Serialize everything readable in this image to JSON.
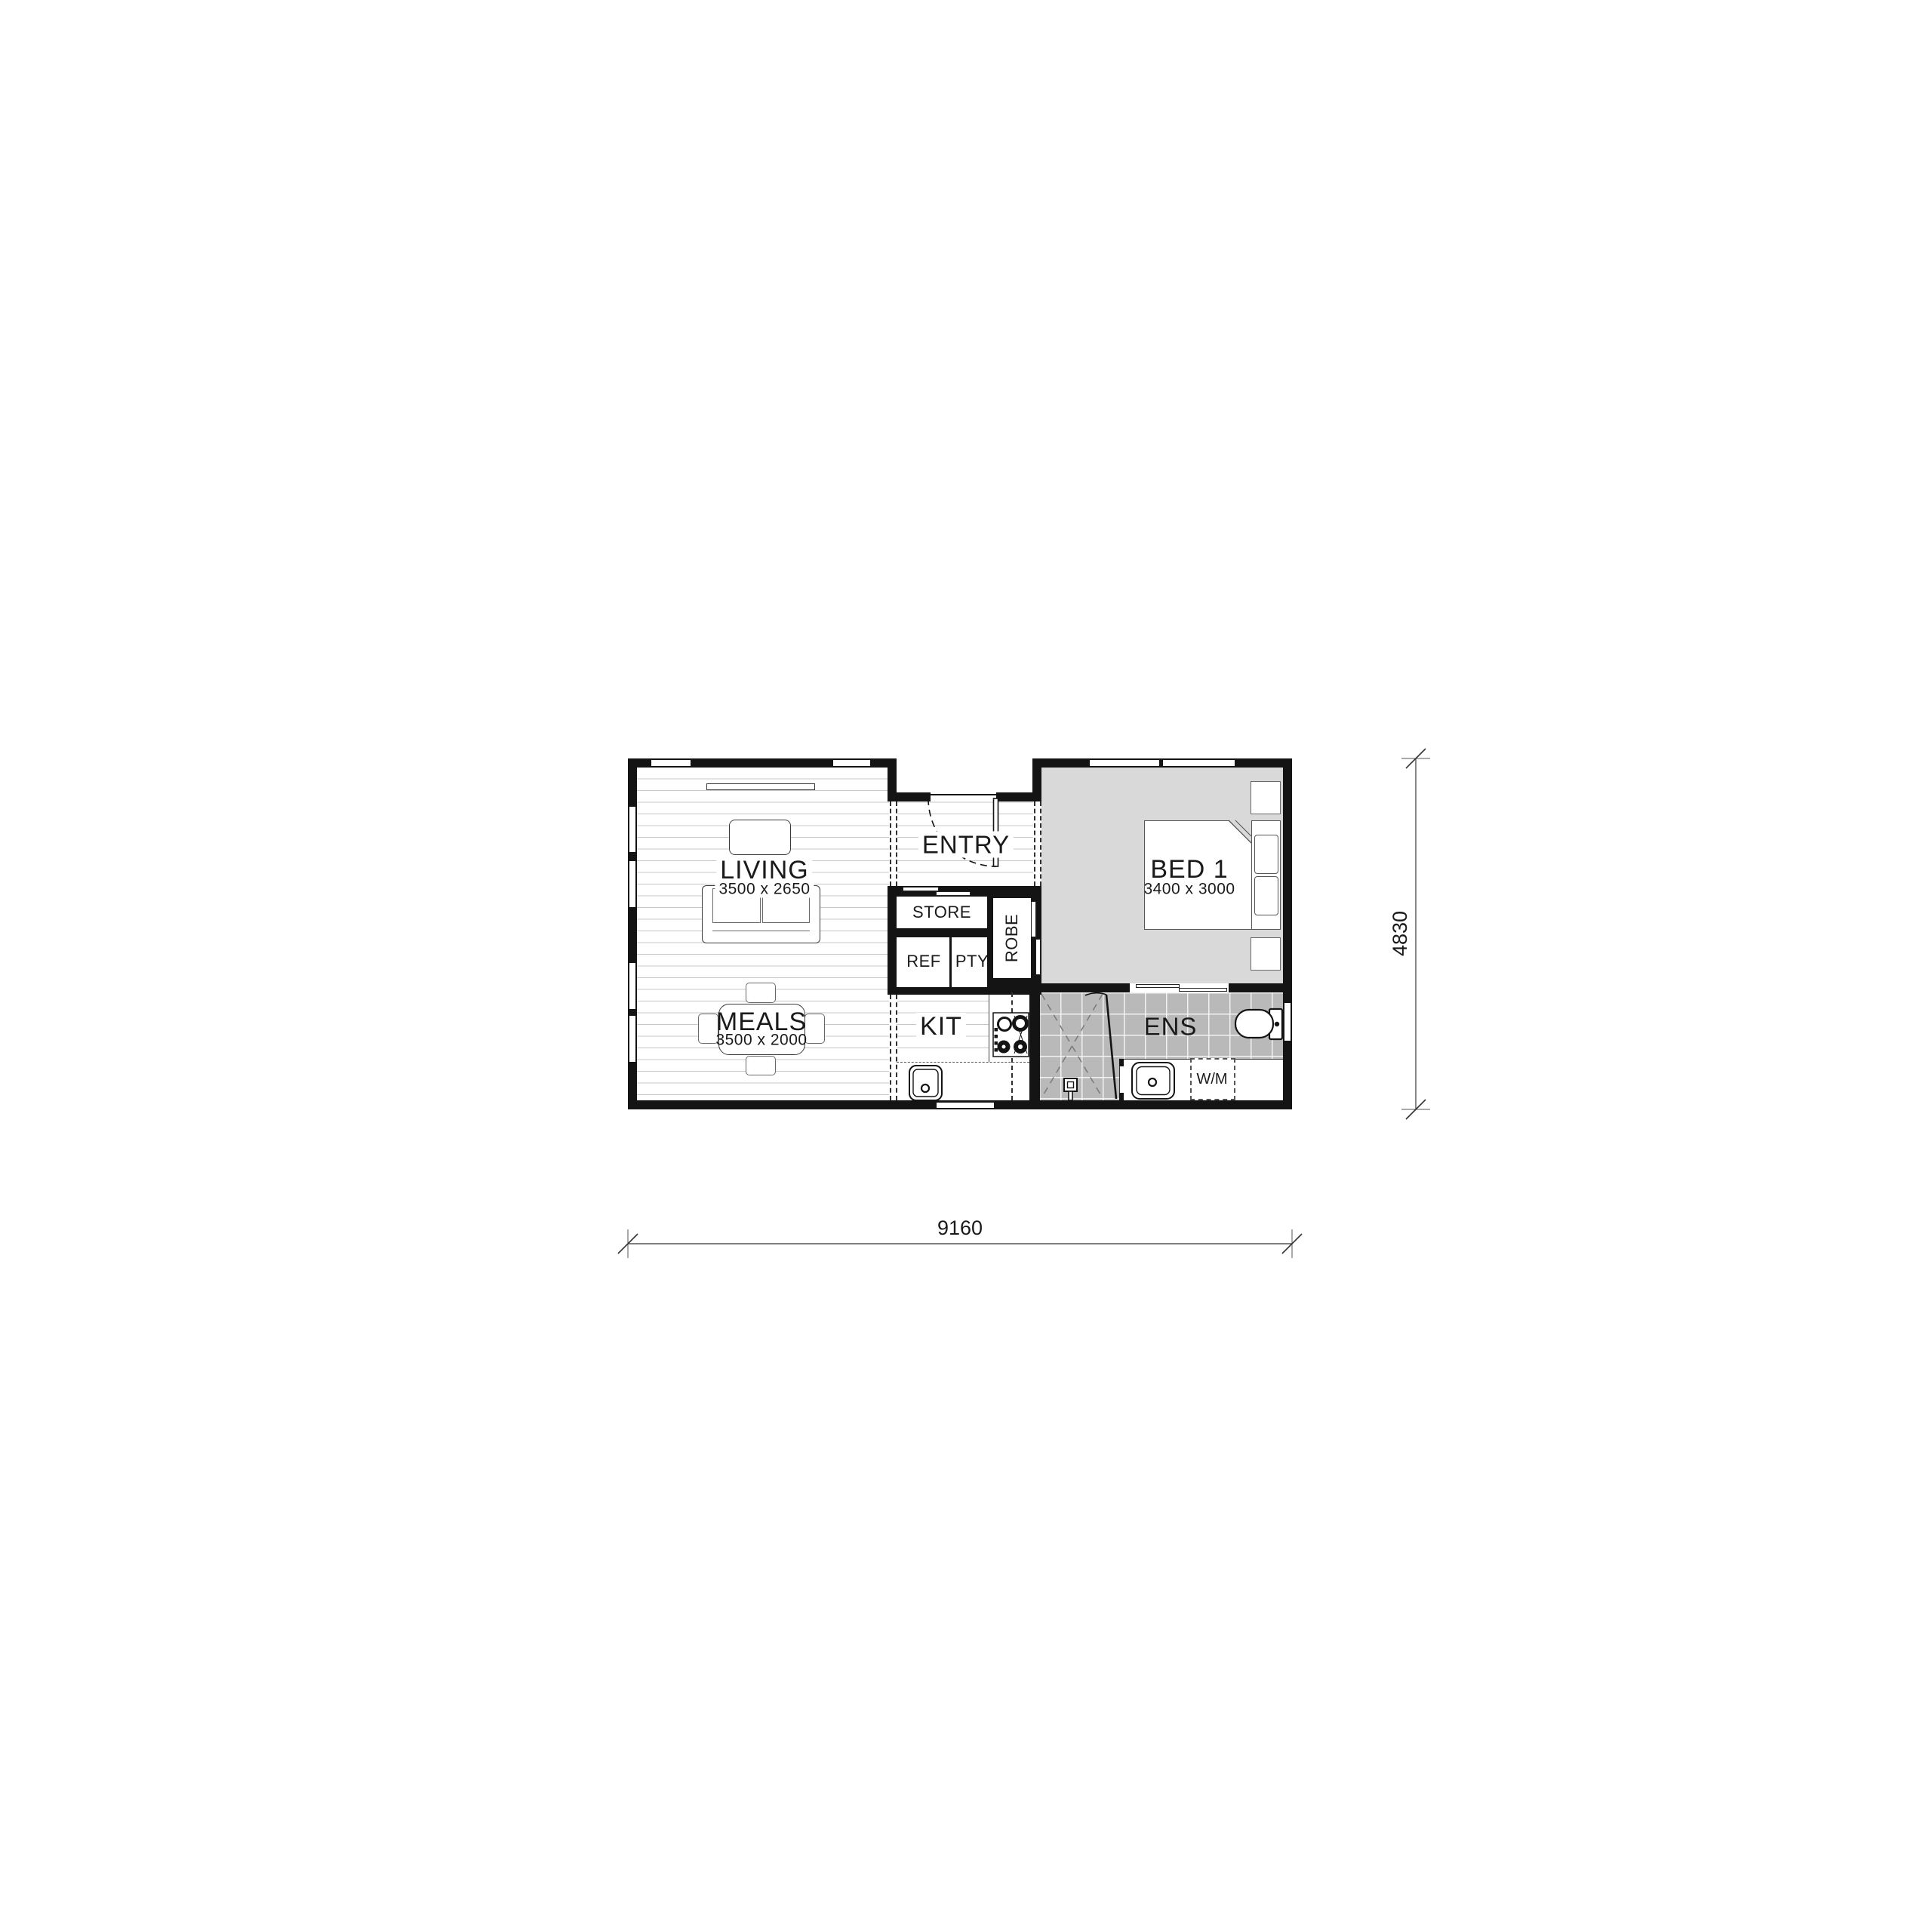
{
  "dimensions": {
    "width": "9160",
    "height": "4830"
  },
  "rooms": {
    "living": {
      "label": "LIVING",
      "size": "3500 x 2650"
    },
    "entry": {
      "label": "ENTRY"
    },
    "meals": {
      "label": "MEALS",
      "size": "3500 x 2000"
    },
    "kit": {
      "label": "KIT"
    },
    "store": {
      "label": "STORE"
    },
    "ref": {
      "label": "REF"
    },
    "pty": {
      "label": "PTY"
    },
    "robe": {
      "label": "ROBE"
    },
    "bed1": {
      "label": "BED 1",
      "size": "3400 x 3000"
    },
    "ens": {
      "label": "ENS"
    },
    "wm": {
      "label": "W/M"
    }
  },
  "colors": {
    "wall": "#141414",
    "floor_line": "#c8c8c8",
    "carpet": "#d9d9d9",
    "tile": "#b9b9b9"
  }
}
